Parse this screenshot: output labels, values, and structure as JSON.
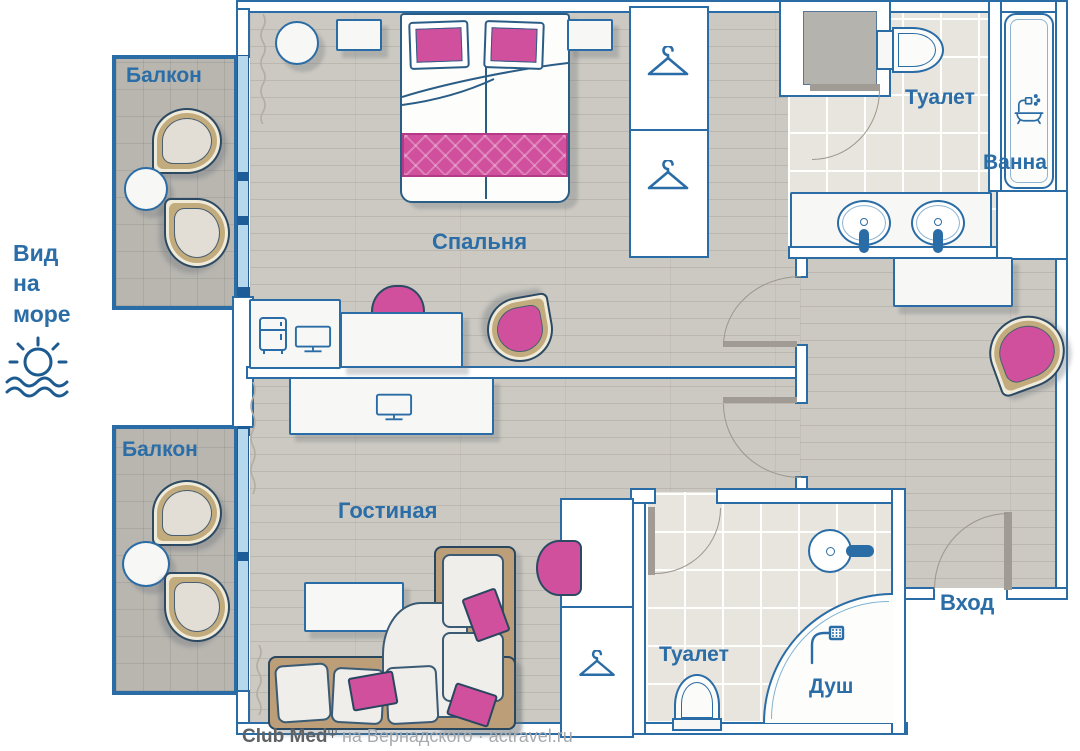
{
  "labels": {
    "balcony_top": "Балкон",
    "balcony_bottom": "Балкон",
    "sea_view": "Вид\nна\nморе",
    "bedroom": "Спальня",
    "living_room": "Гостиная",
    "toilet_top": "Туалет",
    "bath": "Ванна",
    "toilet_bottom": "Туалет",
    "shower": "Душ",
    "entrance": "Вход"
  },
  "watermark": {
    "brand": "Club Med",
    "trident": "Ψ",
    "suffix": "на Вернадского · actravel.ru"
  },
  "icons": {
    "sun_waves": "sun-over-waves-icon",
    "hanger": "hanger-icon",
    "fridge": "fridge-icon",
    "tv": "tv-icon",
    "bathtub": "bathtub-shower-icon",
    "shower_head": "shower-head-icon"
  },
  "colors": {
    "outline": "#2a6ca5",
    "text": "#2a6da7",
    "pink": "#d0509e",
    "window": "#b5d8ec",
    "wood": "#ccc9c2",
    "balcony_floor": "#b9b6b0",
    "tile": "#e8e4de",
    "shell_cream": "#f0ead9",
    "shell_tan": "#c2ab7d"
  }
}
